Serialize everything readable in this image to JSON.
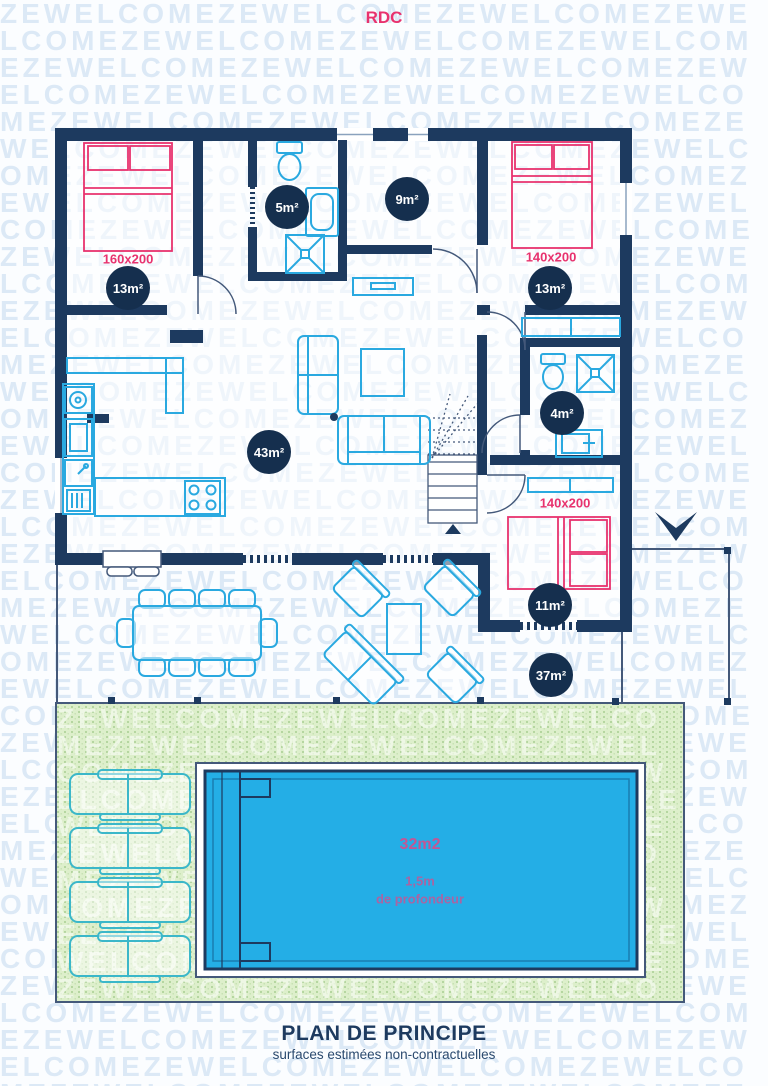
{
  "page": {
    "floor_label": "RDC",
    "title": "PLAN DE PRINCIPE",
    "subtitle": "surfaces estimées non-contractuelles"
  },
  "watermark": {
    "text": "ZEWELCOME"
  },
  "areas": {
    "wc": "5m²",
    "bathroom": "9m²",
    "bedroom_left": "13m²",
    "bedroom_right": "13m²",
    "living": "43m²",
    "shower_room": "4m²",
    "bedroom_bottom": "11m²",
    "terrace": "37m²"
  },
  "bed_sizes": {
    "bedroom_left": "160x200",
    "bedroom_right": "140x200",
    "bedroom_bottom": "140x200"
  },
  "pool": {
    "area": "32m2",
    "depth": "1,5m",
    "depth_caption": "de profondeur"
  },
  "colors": {
    "wall": "#1d3a5f",
    "furniture": "#2aa9e0",
    "bed": "#e8326e",
    "badge_bg": "#152f4e",
    "pool_water": "#24aee6",
    "garden": "#ddefcb",
    "watermark": "#dce9f6",
    "accent_pink": "#e8326e"
  }
}
